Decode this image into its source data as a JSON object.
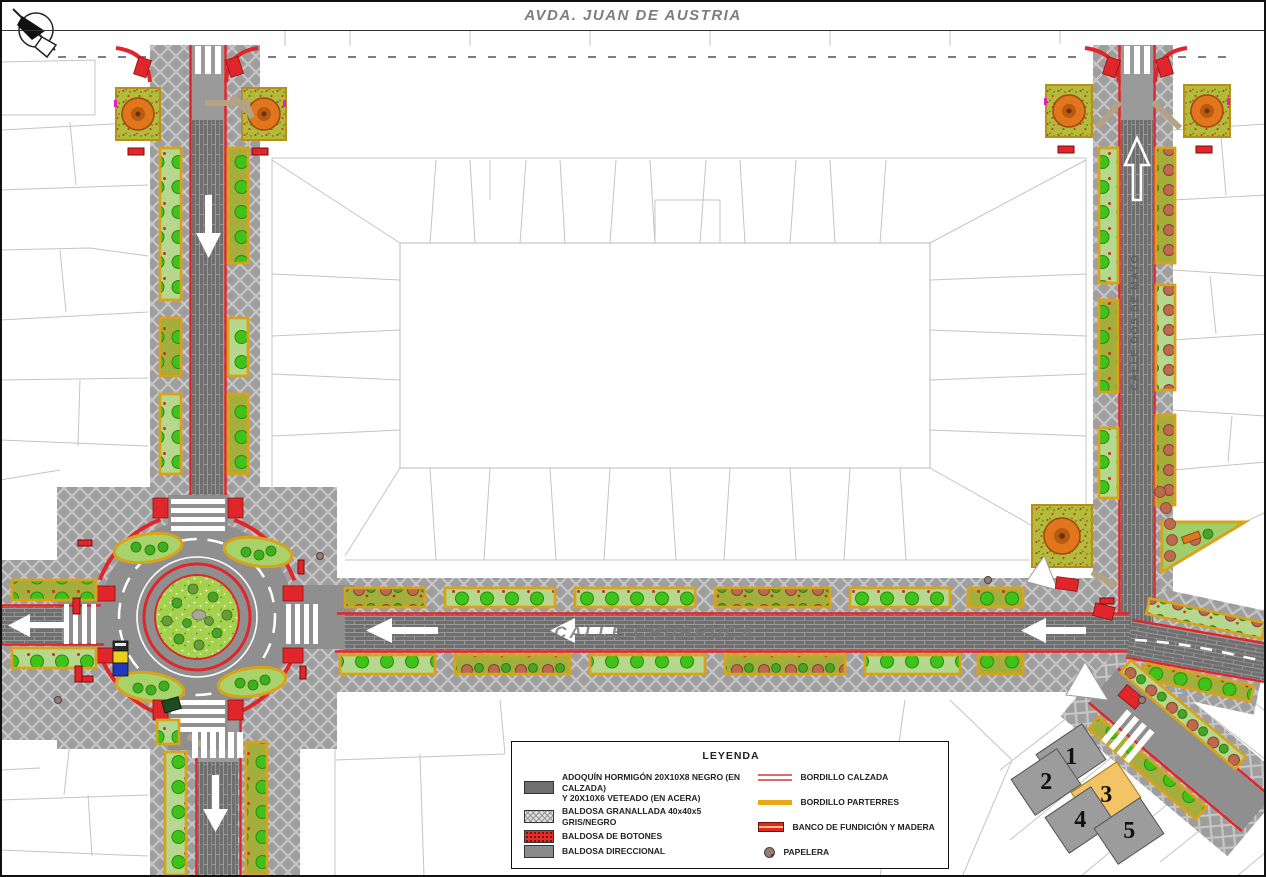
{
  "title": "AVDA. JUAN DE AUSTRIA",
  "street_labels": {
    "churruca": "CALLE CHURRUCA",
    "vertical": "CALLE DOS DE MAYO"
  },
  "icons": {
    "north_arrow": "compass-north-arrow",
    "papelera": "round-litter-bin",
    "banco": "bench-top-view"
  },
  "legend": {
    "title": "LEYENDA",
    "items_left": [
      {
        "swatch": "adoquin",
        "label": "ADOQUÍN HORMIGÓN 20X10X8 NEGRO (EN CALZADA)",
        "label2": "Y 20X10X6 VETEADO (EN ACERA)"
      },
      {
        "swatch": "granallada",
        "label": "BALDOSA GRANALLADA 40x40x5 GRIS/NEGRO",
        "label2": ""
      },
      {
        "swatch": "botones",
        "label": "BALDOSA DE BOTONES",
        "label2": ""
      },
      {
        "swatch": "direccional",
        "label": "BALDOSA DIRECCIONAL",
        "label2": ""
      }
    ],
    "items_right": [
      {
        "swatch": "bordillo-calzada",
        "label": "BORDILLO CALZADA"
      },
      {
        "swatch": "bordillo-parterres",
        "label": "BORDILLO PARTERRES"
      },
      {
        "swatch": "banco",
        "label": "BANCO DE FUNDICIÓN Y MADERA"
      },
      {
        "swatch": "papelera",
        "label": "PAPELERA"
      }
    ]
  },
  "sheet_index": {
    "tiles": [
      {
        "num": "1",
        "active": false
      },
      {
        "num": "2",
        "active": false
      },
      {
        "num": "3",
        "active": true
      },
      {
        "num": "4",
        "active": false
      },
      {
        "num": "5",
        "active": false
      }
    ]
  },
  "colors": {
    "curb_red": "#e0262a",
    "parterre_orange": "#d9a21b",
    "planter_green": "#b6d88e",
    "sidewalk_gray": "#9e9e9e",
    "roadway_gray": "#6f6f6f",
    "active_tile": "#f2c465",
    "title_gray": "#7d7d7d"
  }
}
